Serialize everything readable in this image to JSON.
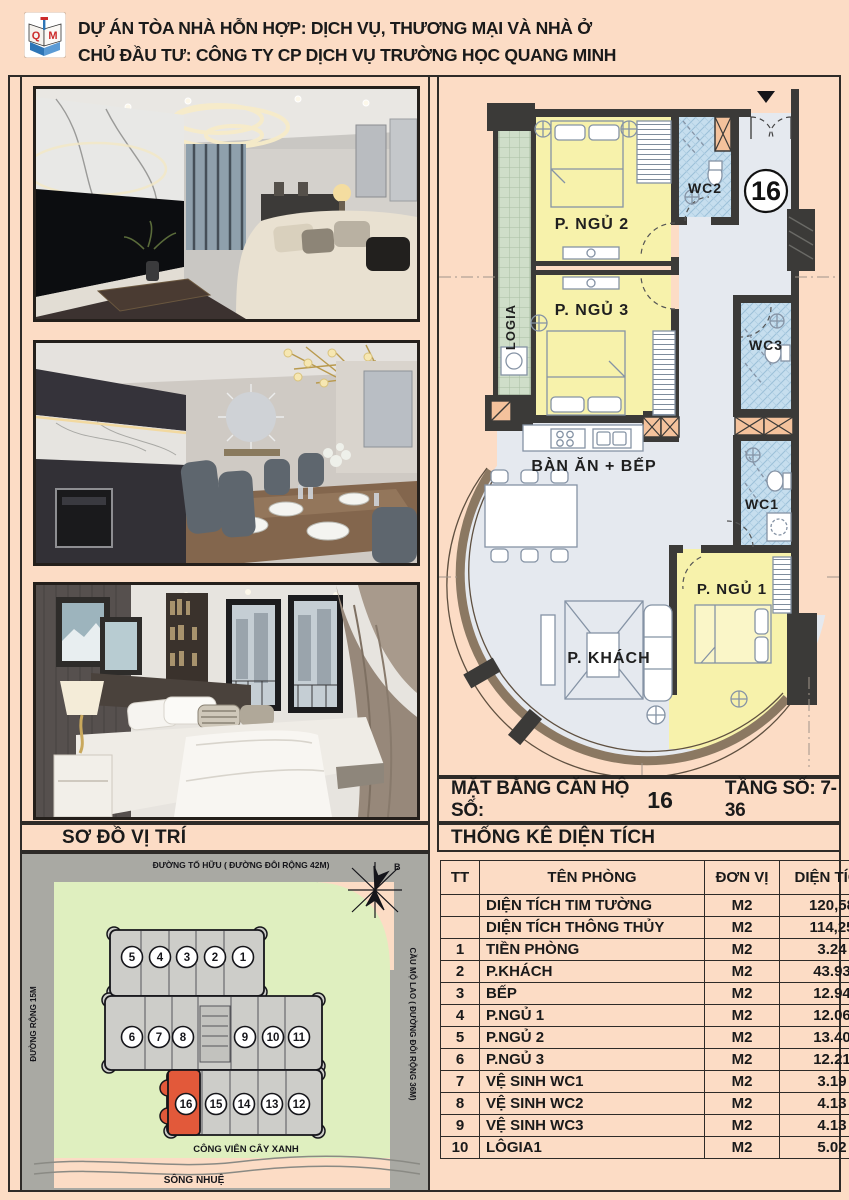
{
  "header": {
    "line1": "DỰ ÁN TÒA NHÀ HỖN HỢP: DỊCH VỤ, THƯƠNG MẠI VÀ NHÀ Ở",
    "line2": "CHỦ ĐẦU TƯ: CÔNG TY CP DỊCH VỤ TRƯỜNG HỌC QUANG MINH",
    "logo": {
      "letter_left": "Q",
      "letter_right": "M"
    }
  },
  "floor_plan": {
    "unit_badge": "16",
    "rooms": {
      "logia": "LOGIA",
      "bedroom2": "P. NGỦ 2",
      "bedroom3": "P. NGỦ 3",
      "wc2": "WC2",
      "wc3": "WC3",
      "wc1": "WC1",
      "dining_kitchen": "BÀN ĂN + BẾP",
      "living": "P. KHÁCH",
      "bedroom1": "P. NGỦ 1"
    },
    "caption": {
      "label": "MẶT BẰNG CĂN HỘ SỐ:",
      "unit": "16",
      "floors": "TẦNG SỐ: 7-36"
    }
  },
  "sections": {
    "site_map_title": "SƠ ĐỒ VỊ TRÍ",
    "stats_title": "THỐNG KÊ DIỆN TÍCH"
  },
  "site_map": {
    "street_top": "ĐƯỜNG TỐ HỮU ( ĐƯỜNG ĐÔI RỘNG 42M)",
    "street_left": "ĐƯỜNG RỘNG 15M",
    "street_right": "CẦU MỘ LAO ( ĐƯỜNG ĐÔI RỘNG 36M)",
    "park": "CÔNG VIÊN CÂY XANH",
    "river": "SÔNG NHUỆ",
    "compass": "B",
    "units": [
      "5",
      "4",
      "3",
      "2",
      "1",
      "6",
      "7",
      "8",
      "9",
      "10",
      "11",
      "16",
      "15",
      "14",
      "13",
      "12"
    ],
    "highlighted_unit": "16",
    "colors": {
      "highlight": "#e2593a",
      "park": "#dfefbf",
      "street": "#a9a9a3",
      "building": "#cdcdc9",
      "page": "#fcdcc5",
      "room_yellow": "#f7f2ab",
      "room_wc": "#c6deee",
      "floor": "#e5e9ef",
      "wall": "#3b3a38"
    }
  },
  "stat_table": {
    "headers": [
      "TT",
      "TÊN PHÒNG",
      "ĐƠN VỊ",
      "DIỆN TÍCH"
    ],
    "rows": [
      [
        "",
        "DIỆN TÍCH TIM TƯỜNG",
        "M2",
        "120,58"
      ],
      [
        "",
        "DIỆN TÍCH THÔNG THỦY",
        "M2",
        "114,25"
      ],
      [
        "1",
        "TIỀN PHÒNG",
        "M2",
        "3.24"
      ],
      [
        "2",
        "P.KHÁCH",
        "M2",
        "43.93"
      ],
      [
        "3",
        "BẾP",
        "M2",
        "12.94"
      ],
      [
        "4",
        "P.NGỦ 1",
        "M2",
        "12.06"
      ],
      [
        "5",
        "P.NGỦ 2",
        "M2",
        "13.40"
      ],
      [
        "6",
        "P.NGỦ 3",
        "M2",
        "12.21"
      ],
      [
        "7",
        "VỆ SINH WC1",
        "M2",
        "3.19"
      ],
      [
        "8",
        "VỆ SINH WC2",
        "M2",
        "4.13"
      ],
      [
        "9",
        "VỆ SINH WC3",
        "M2",
        "4.13"
      ],
      [
        "10",
        "LÔGIA1",
        "M2",
        "5.02"
      ]
    ]
  }
}
